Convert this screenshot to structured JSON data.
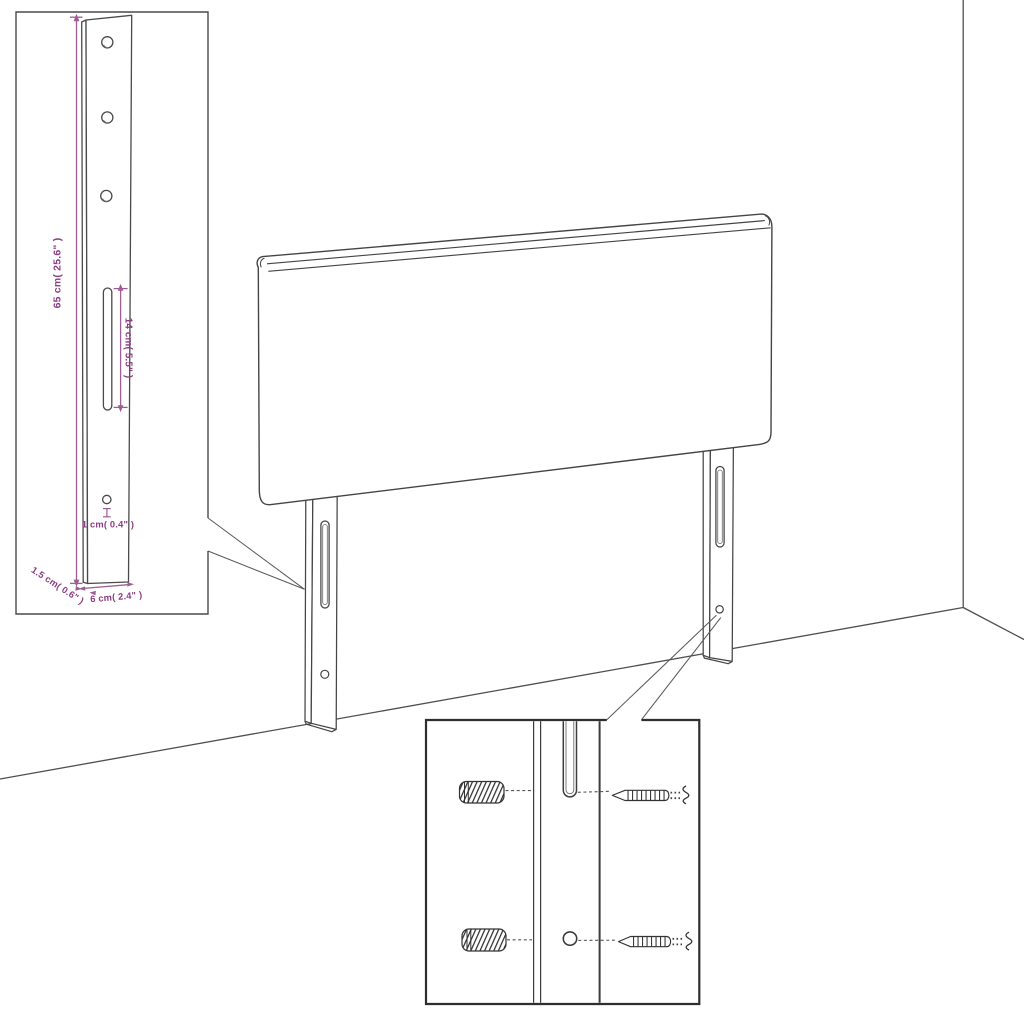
{
  "figure": {
    "type": "furniture-assembly-diagram",
    "subject": "headboard with two mounting legs, wall corner, leg dimension inset and wall-mounting hardware inset"
  },
  "colors": {
    "background": "#ffffff",
    "outline": "#454545",
    "inner_contour": "#6f6f6f",
    "callout": "#5a5a5a",
    "inset_border": "#2e2e2e",
    "dimension_line": "#9c5e94",
    "dimension_text": "#8c3c82",
    "hardware": "#333333"
  },
  "leg_detail": {
    "height_label": "65 cm( 25.6\" )",
    "slot_label": "14 cm( 5.5\" )",
    "hole_label": "1 cm( 0.4\" )",
    "thickness_label": "1.5 cm( 0.6\" )",
    "width_label": "6 cm( 2.4\" )"
  }
}
